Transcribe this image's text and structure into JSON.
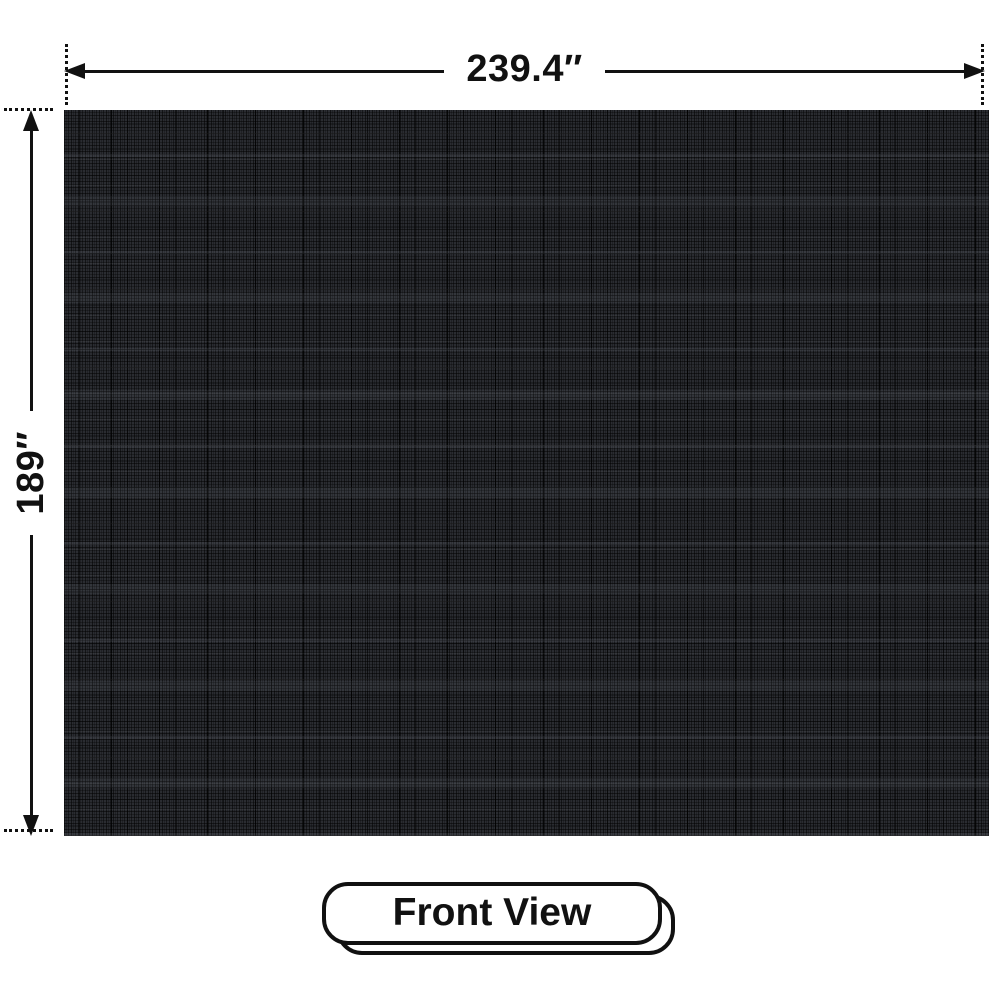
{
  "diagram": {
    "width_label": "239.4″",
    "height_label": "189″",
    "view_label": "Front View"
  },
  "colors": {
    "background": "#ffffff",
    "line": "#111111",
    "label_text": "#111111",
    "panel_base": "#2a2c31"
  },
  "icons": {
    "arrow_left": "triangle-arrowhead-left",
    "arrow_right": "triangle-arrowhead-right",
    "arrow_up": "triangle-arrowhead-up",
    "arrow_down": "triangle-arrowhead-down"
  }
}
